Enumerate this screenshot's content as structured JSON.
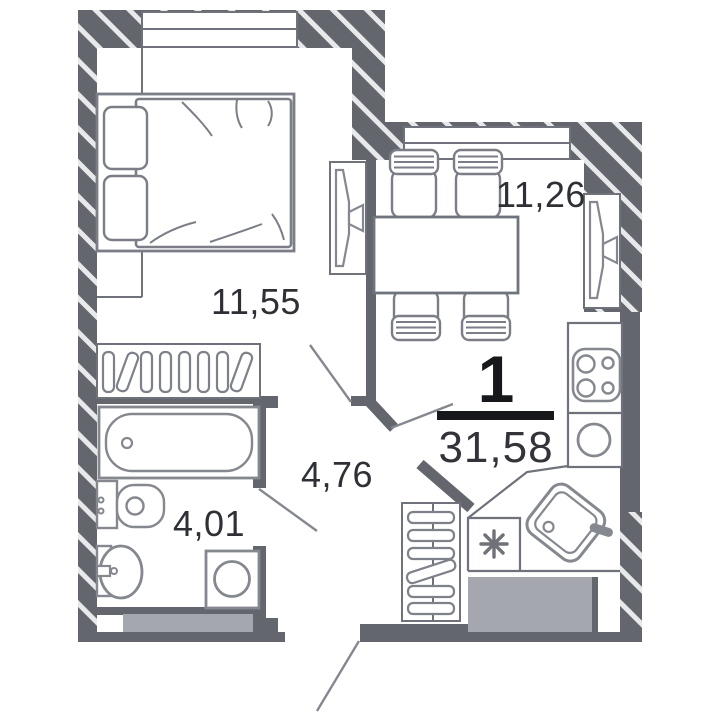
{
  "plan": {
    "rooms_count": "1",
    "total_area": "31,58",
    "rooms": {
      "bedroom": {
        "area": "11,55"
      },
      "kitchen_living": {
        "area": "11,26"
      },
      "hallway": {
        "area": "4,76"
      },
      "bathroom": {
        "area": "4,01"
      }
    },
    "colors": {
      "wall": "#63666d",
      "wall_hatch_stripe": "#e8e9eb",
      "fixture_outline": "#85888f",
      "furniture_outline": "#7b7e86",
      "partition_line": "#6f727a",
      "block_fill": "#a4a7ae",
      "label_text": "#2e3036",
      "accent_black": "#17181c"
    }
  }
}
